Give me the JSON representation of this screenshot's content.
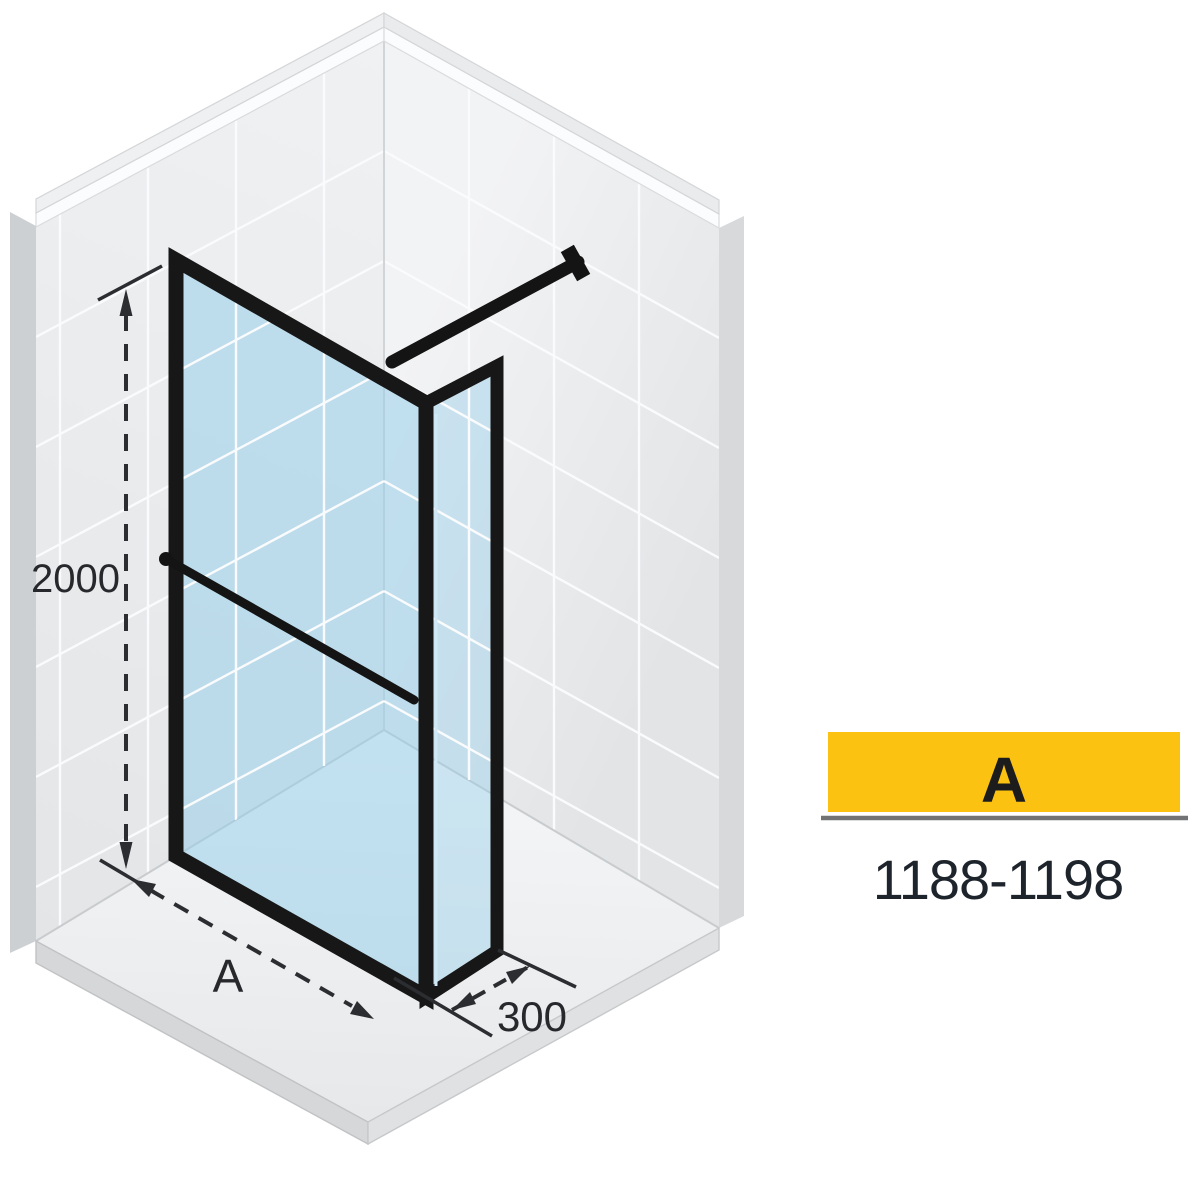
{
  "diagram": {
    "dimension_height": "2000",
    "dimension_width": "A",
    "dimension_depth": "300"
  },
  "spec": {
    "badge_label": "A",
    "width_range_mm": "1188-1198"
  },
  "colors": {
    "badge_yellow": "#fcc211",
    "badge_underline": "#717375",
    "frame_black": "#171717",
    "glass_blue": "#94cde9",
    "dimension_ink": "#2b2d30"
  }
}
